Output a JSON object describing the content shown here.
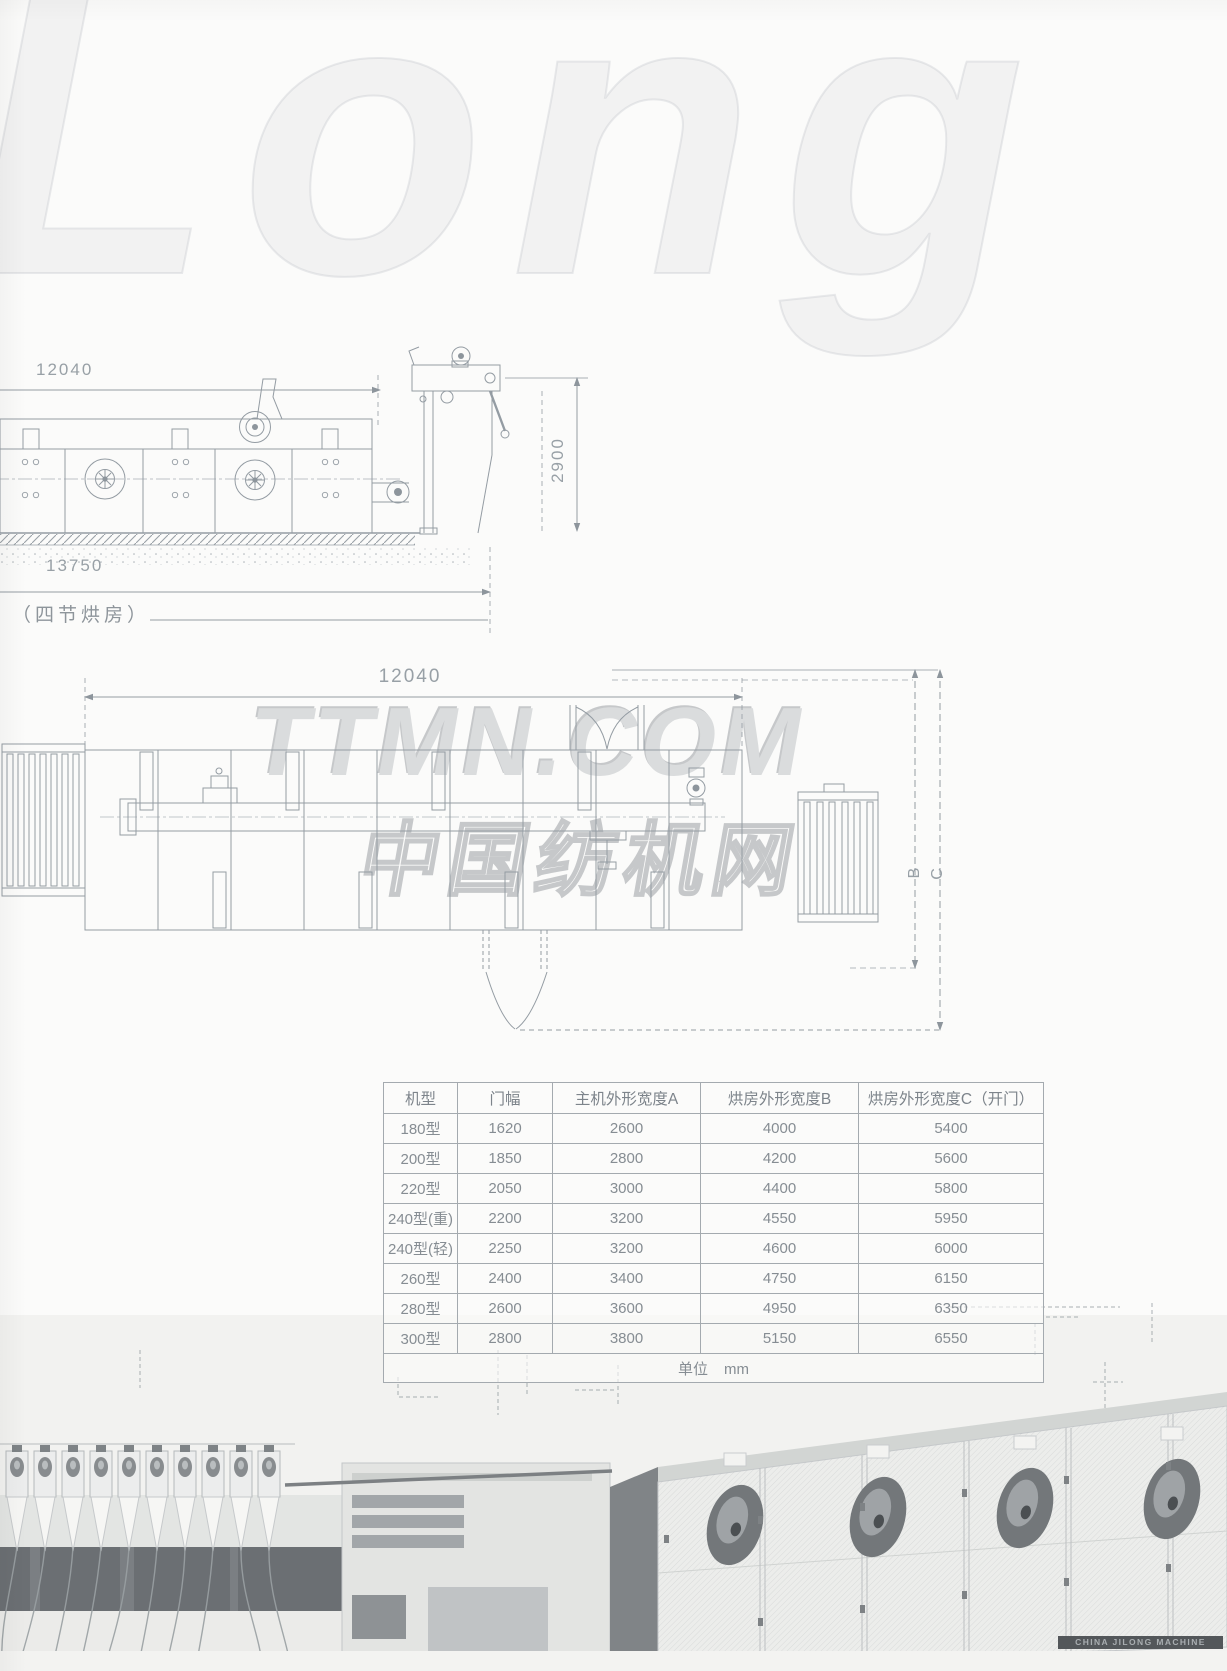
{
  "watermarks": {
    "logo": "Long",
    "site": "TTMN.COM",
    "site_cn": "中国纺机网"
  },
  "side_view": {
    "dim_length": "12040",
    "dim_total_length": "13750",
    "dim_height": "2900",
    "caption": "（四节烘房）"
  },
  "plan_view": {
    "dim_length": "12040",
    "dim_label_b": "B",
    "dim_label_c": "C"
  },
  "spec_table": {
    "headers": [
      "机型",
      "门幅",
      "主机外形宽度A",
      "烘房外形宽度B",
      "烘房外形宽度C（开门）"
    ],
    "rows": [
      [
        "180型",
        "1620",
        "2600",
        "4000",
        "5400"
      ],
      [
        "200型",
        "1850",
        "2800",
        "4200",
        "5600"
      ],
      [
        "220型",
        "2050",
        "3000",
        "4400",
        "5800"
      ],
      [
        "240型(重)",
        "2200",
        "3200",
        "4550",
        "5950"
      ],
      [
        "240型(轻)",
        "2250",
        "3200",
        "4600",
        "6000"
      ],
      [
        "260型",
        "2400",
        "3400",
        "4750",
        "6150"
      ],
      [
        "280型",
        "2600",
        "3600",
        "4950",
        "6350"
      ],
      [
        "300型",
        "2800",
        "3800",
        "5150",
        "6550"
      ]
    ],
    "unit_label": "单位",
    "unit_value": "mm"
  },
  "footer": {
    "brand": "CHINA JILONG MACHINE"
  },
  "colors": {
    "drawing_line": "#939ba2",
    "table_text": "#878e94",
    "table_border": "#a4aaaf",
    "watermark_gray": "#d8dadb",
    "brand_bar_bg": "#53575a"
  }
}
